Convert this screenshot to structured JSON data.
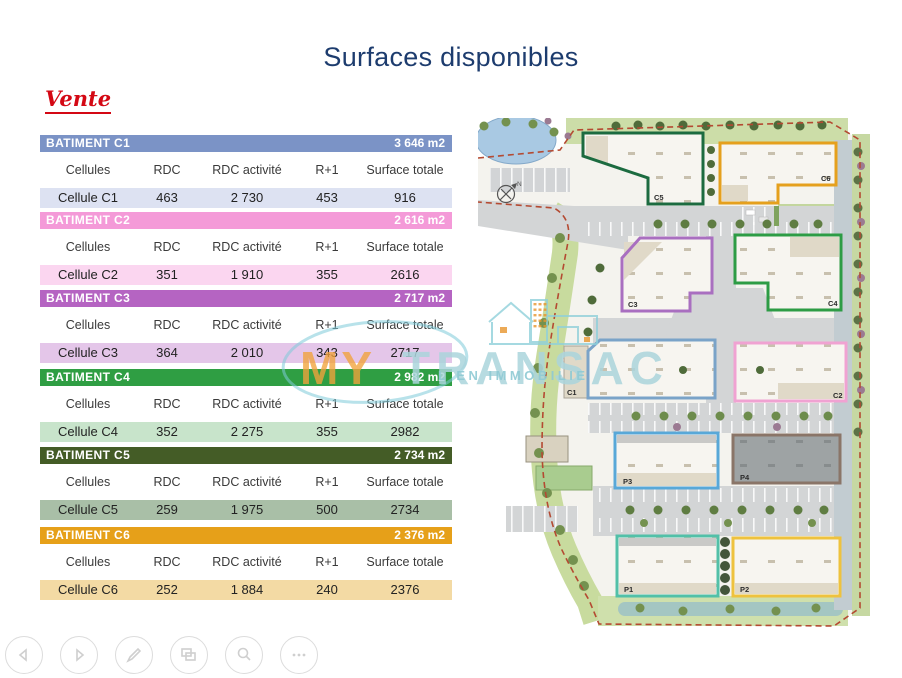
{
  "page": {
    "title": "Surfaces disponibles",
    "subtitle": "Vente"
  },
  "columns": [
    "Cellules",
    "RDC",
    "RDC activité",
    "R+1",
    "Surface totale"
  ],
  "tables": [
    {
      "title": "BATIMENT C1",
      "area": "3 646 m2",
      "header_color": "#7b93c6",
      "row_color": "#dde2f2",
      "row": [
        "Cellule C1",
        "463",
        "2 730",
        "453",
        "916"
      ]
    },
    {
      "title": "BATIMENT C2",
      "area": "2 616 m2",
      "header_color": "#f49ad8",
      "row_color": "#fbd6f0",
      "row": [
        "Cellule C2",
        "351",
        "1 910",
        "355",
        "2616"
      ]
    },
    {
      "title": "BATIMENT C3",
      "area": "2 717 m2",
      "header_color": "#b564c2",
      "row_color": "#e4c6e9",
      "row": [
        "Cellule C3",
        "364",
        "2 010",
        "343",
        "2717"
      ]
    },
    {
      "title": "BATIMENT C4",
      "area": "2 982 m2",
      "header_color": "#2f9e43",
      "row_color": "#c8e4cb",
      "row": [
        "Cellule C4",
        "352",
        "2 275",
        "355",
        "2982"
      ]
    },
    {
      "title": "BATIMENT C5",
      "area": "2 734 m2",
      "header_color": "#445c26",
      "row_color": "#a9bfa7",
      "row": [
        "Cellule C5",
        "259",
        "1 975",
        "500",
        "2734"
      ]
    },
    {
      "title": "BATIMENT C6",
      "area": "2 376 m2",
      "header_color": "#e6a019",
      "row_color": "#f3daa4",
      "row": [
        "Cellule C6",
        "252",
        "1 884",
        "240",
        "2376"
      ]
    }
  ],
  "map": {
    "compass_label": "N",
    "buildings": [
      {
        "label": "C5",
        "color": "#1c6b40"
      },
      {
        "label": "C6",
        "color": "#e5a01d"
      },
      {
        "label": "C3",
        "color": "#a96fc0"
      },
      {
        "label": "C4",
        "color": "#2d9c45"
      },
      {
        "label": "C1",
        "color": "#7aa3c8"
      },
      {
        "label": "C2",
        "color": "#f0a2d2"
      },
      {
        "label": "P3",
        "color": "#58a8d8"
      },
      {
        "label": "P4",
        "color": "#8a7568"
      },
      {
        "label": "P1",
        "color": "#52c0a8"
      },
      {
        "label": "P2",
        "color": "#eec23e"
      }
    ]
  },
  "watermark": {
    "word1": "MY",
    "word2": "TRANSAC",
    "tagline": "L EN IMMOBILIE",
    "orange": "#f2a33c",
    "teal": "#9fd2da"
  },
  "toolbar": {
    "buttons": [
      "previous",
      "next",
      "pen",
      "slides",
      "zoom",
      "more"
    ]
  }
}
